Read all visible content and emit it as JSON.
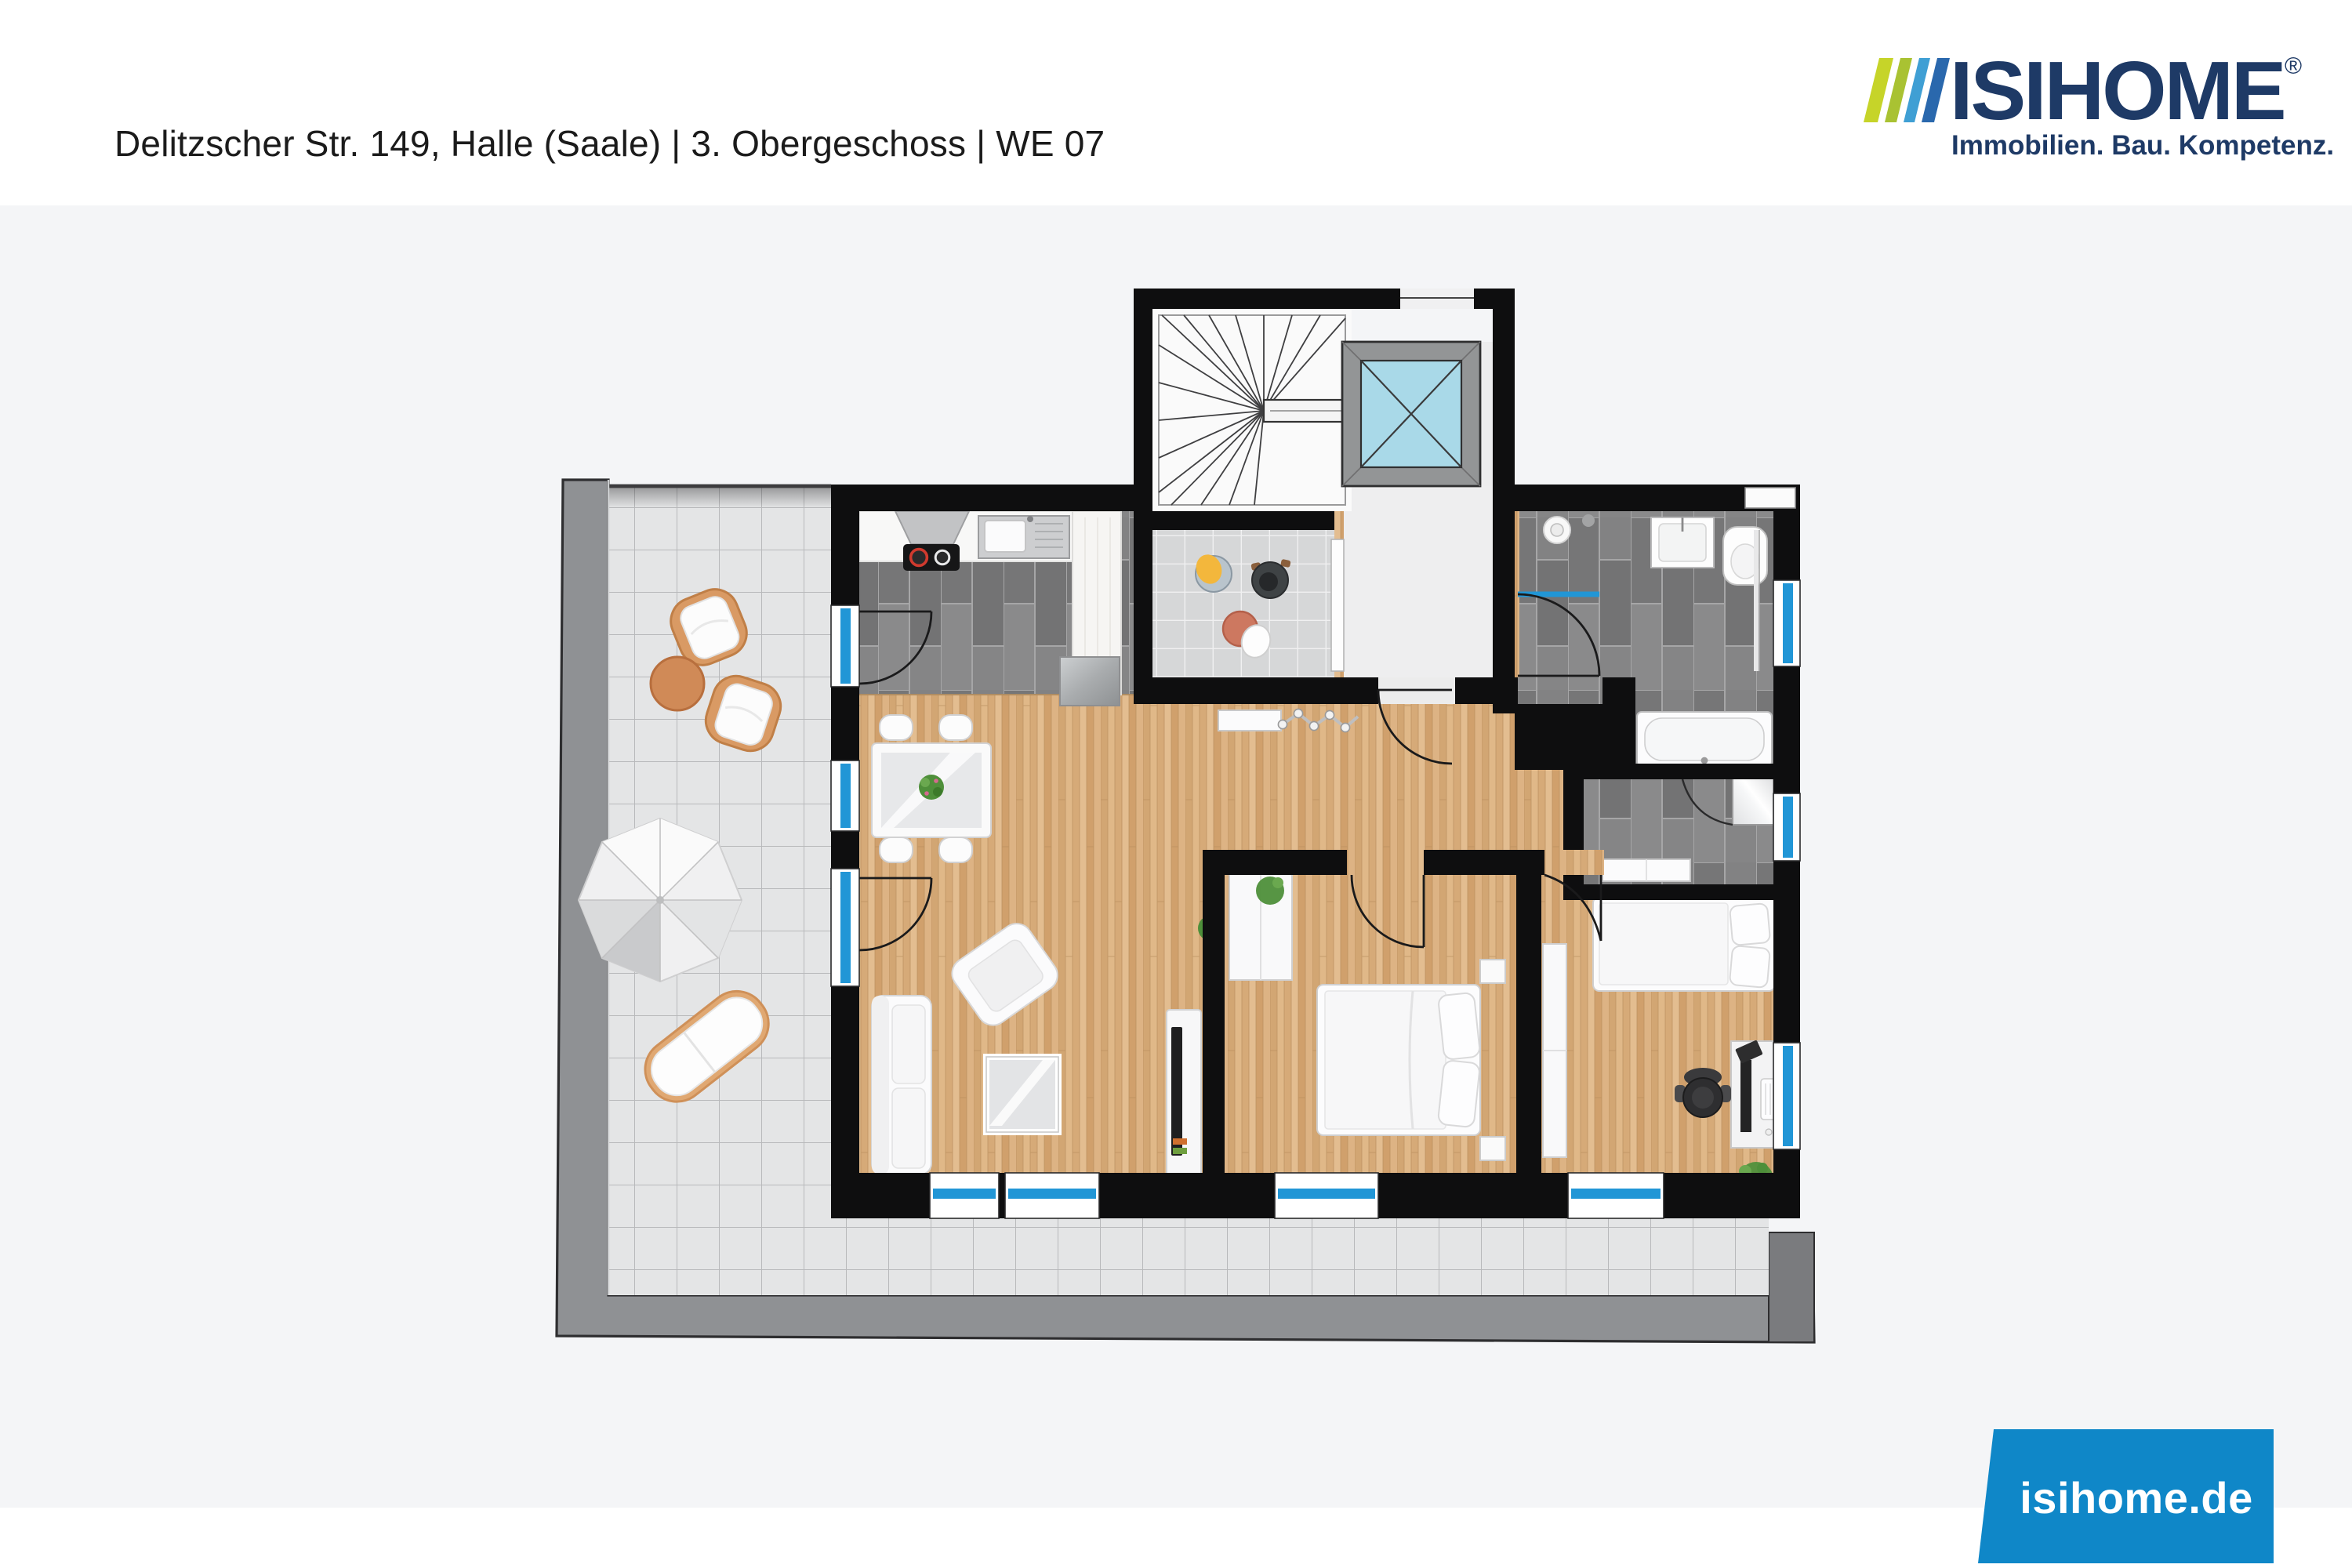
{
  "header": {
    "title": "Delitzscher Str. 149, Halle (Saale) | 3. Obergeschoss | WE 07"
  },
  "logo": {
    "brand": "ISIHOME",
    "registered_mark": "®",
    "tagline": "Immobilien. Bau. Kompetenz.",
    "navy": "#1e3a66",
    "stripe_colors": [
      "#c6d429",
      "#a9c232",
      "#3f9fd4",
      "#2a68ad"
    ]
  },
  "footer": {
    "website": "isihome.de",
    "box_color": "#0f87c8",
    "text_color": "#ffffff"
  },
  "floorplan": {
    "colors": {
      "background_grey": "#f4f5f7",
      "wall": "#0e0e0f",
      "wood_floor": "#d9b07e",
      "dark_tile": "#7e7e7f",
      "light_tile": "#d6d7d8",
      "terrace_tile": "#e4e5e6",
      "parapet": "#8f9194",
      "glazing_blue": "#2196d6",
      "elevator_cab": "#a9d9e8",
      "wicker_orange": "#d99a64",
      "terracotta_table": "#cd7860",
      "plant_green": "#4e8f3a",
      "hob_red": "#d03a2e"
    }
  }
}
